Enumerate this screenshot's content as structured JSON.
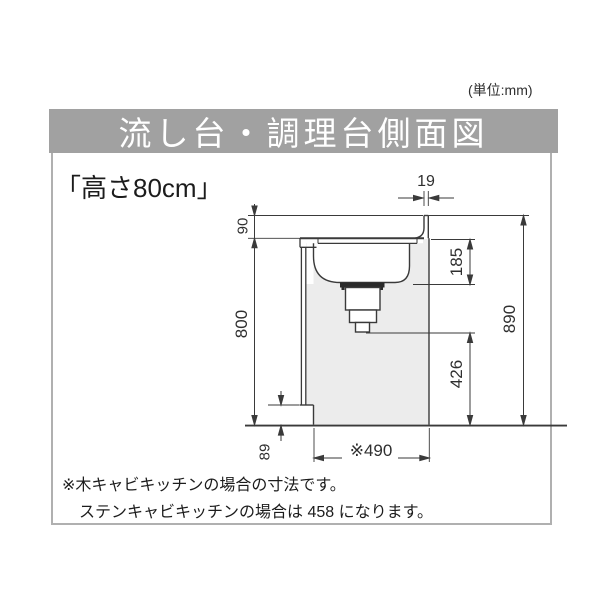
{
  "unit_label": "(単位:mm)",
  "title": "流し台・調理台側面図",
  "height_label": "「高さ80cm」",
  "dims": {
    "backsplash_width": "19",
    "backsplash_height": "90",
    "counter_height": "800",
    "sink_depth": "185",
    "drain_clearance": "426",
    "total_height": "890",
    "toe_kick_height": "89",
    "base_depth": "※490"
  },
  "notes": {
    "line1": "※木キャビキッチンの場合の寸法です。",
    "line2": "ステンキャビキッチンの場合は 458 になります。"
  },
  "colors": {
    "title_bar": "#a1a1a1",
    "title_text": "#ffffff",
    "frame_border": "#b0b0b0",
    "line": "#3a3a3a",
    "cabinet_fill": "#ececec",
    "drain_flange": "#2a2a2a"
  }
}
